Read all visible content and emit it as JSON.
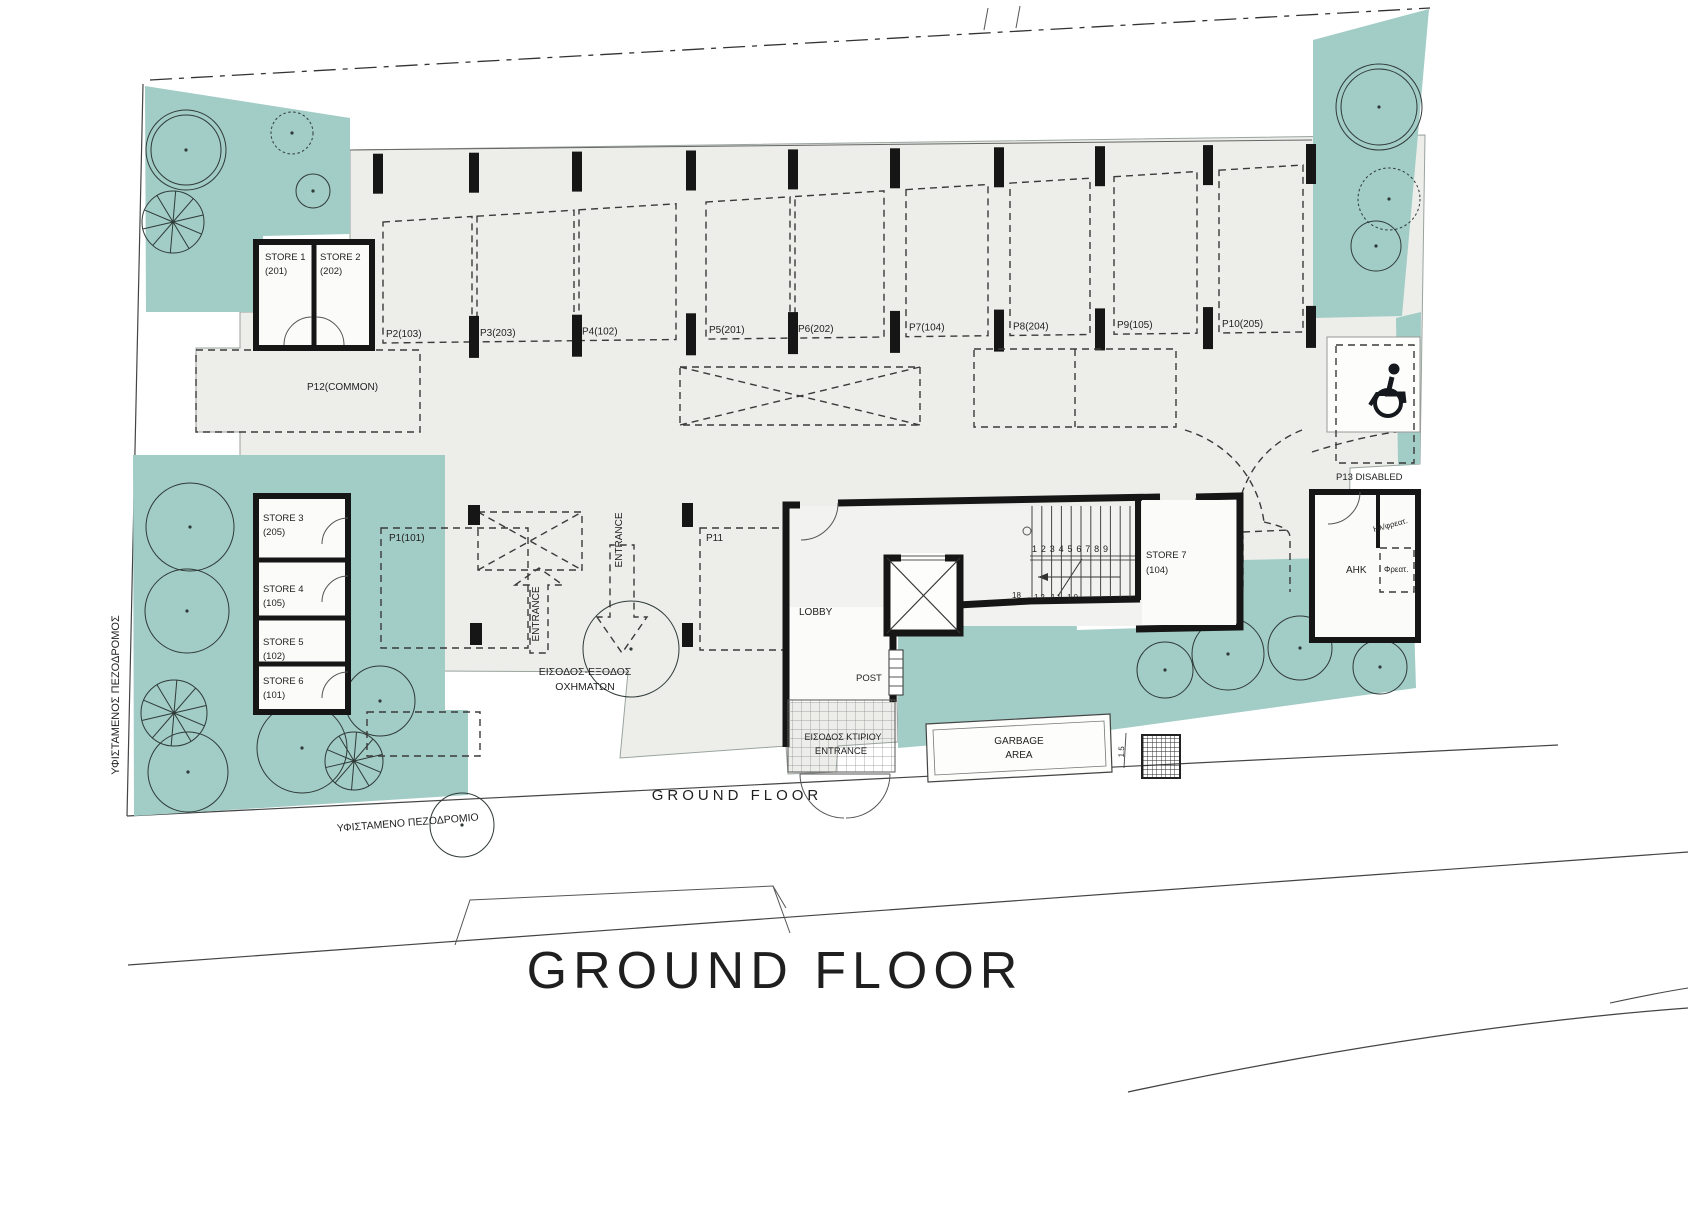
{
  "titles": {
    "plan_title": "GROUND FLOOR",
    "floor_label": "GROUND  FLOOR"
  },
  "site_labels": {
    "existing_sidewalk_vertical": "ΥΦΙΣΤΑΜΕΝΟΣ ΠΕΖΟΔΡΟΜΟΣ",
    "existing_sidewalk_bottom": "ΥΦΙΣΤΑΜΕΝΟ ΠΕΖΟΔΡΟΜΙΟ"
  },
  "entrance": {
    "vehicle_line1": "ΕΙΣΟΔΟΣ-ΕΞΟΔΟΣ",
    "vehicle_line2": "ΟΧΗΜΑΤΩΝ",
    "arrow_in": "ENTRANCE",
    "arrow_out": "ENTRANCE",
    "building_gr": "ΕΙΣΟΔΟΣ ΚΤΙΡΙΟΥ",
    "building_en": "ENTRANCE"
  },
  "core": {
    "lobby": "LOBBY",
    "post": "POST",
    "stair_numbers_top": "1 2 3 4 5 6 7 8 9",
    "stair_number_left": "18",
    "stair_numbers_bottom": "12 11 10"
  },
  "rooms": {
    "ahk": "AHK",
    "shaft": "Φρεατ.",
    "el_shaft": "Ηλ/φρεατ.",
    "garbage_line1": "GARBAGE",
    "garbage_line2": "AREA",
    "garbage_dim": "1.5",
    "disabled_label": "P13 DISABLED"
  },
  "stores": [
    {
      "name": "STORE 1",
      "num": "(201)"
    },
    {
      "name": "STORE 2",
      "num": "(202)"
    },
    {
      "name": "STORE 3",
      "num": "(205)"
    },
    {
      "name": "STORE 4",
      "num": "(105)"
    },
    {
      "name": "STORE 5",
      "num": "(102)"
    },
    {
      "name": "STORE 6",
      "num": "(101)"
    },
    {
      "name": "STORE 7",
      "num": "(104)"
    }
  ],
  "parking": [
    {
      "label": "P1(101)"
    },
    {
      "label": "P2(103)"
    },
    {
      "label": "P3(203)"
    },
    {
      "label": "P4(102)"
    },
    {
      "label": "P5(201)"
    },
    {
      "label": "P6(202)"
    },
    {
      "label": "P7(104)"
    },
    {
      "label": "P8(204)"
    },
    {
      "label": "P9(105)"
    },
    {
      "label": "P10(205)"
    },
    {
      "label": "P11"
    },
    {
      "label": "P12(COMMON)"
    }
  ],
  "colors": {
    "landscape_teal": "#a2ccc6",
    "building_gray": "#edeeea",
    "wall_black": "#161616"
  }
}
